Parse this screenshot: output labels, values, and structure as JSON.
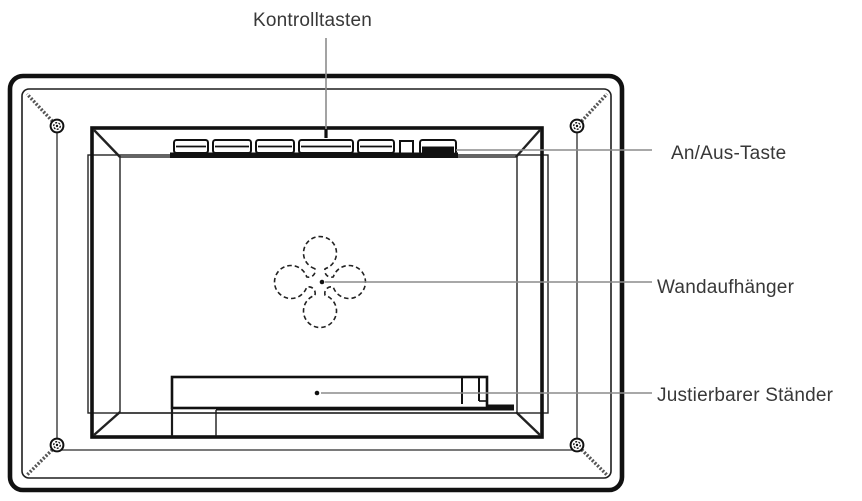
{
  "figure": {
    "type": "technical-diagram",
    "labels": {
      "control_buttons": "Kontrolltasten",
      "power_button": "An/Aus-Taste",
      "wall_hanger": "Wandaufhänger",
      "adjustable_stand": "Justierbarer Ständer"
    },
    "colors": {
      "line": "#1a1a1a",
      "leader_line": "#8c8c8c",
      "text": "#383838",
      "background": "#ffffff"
    }
  }
}
